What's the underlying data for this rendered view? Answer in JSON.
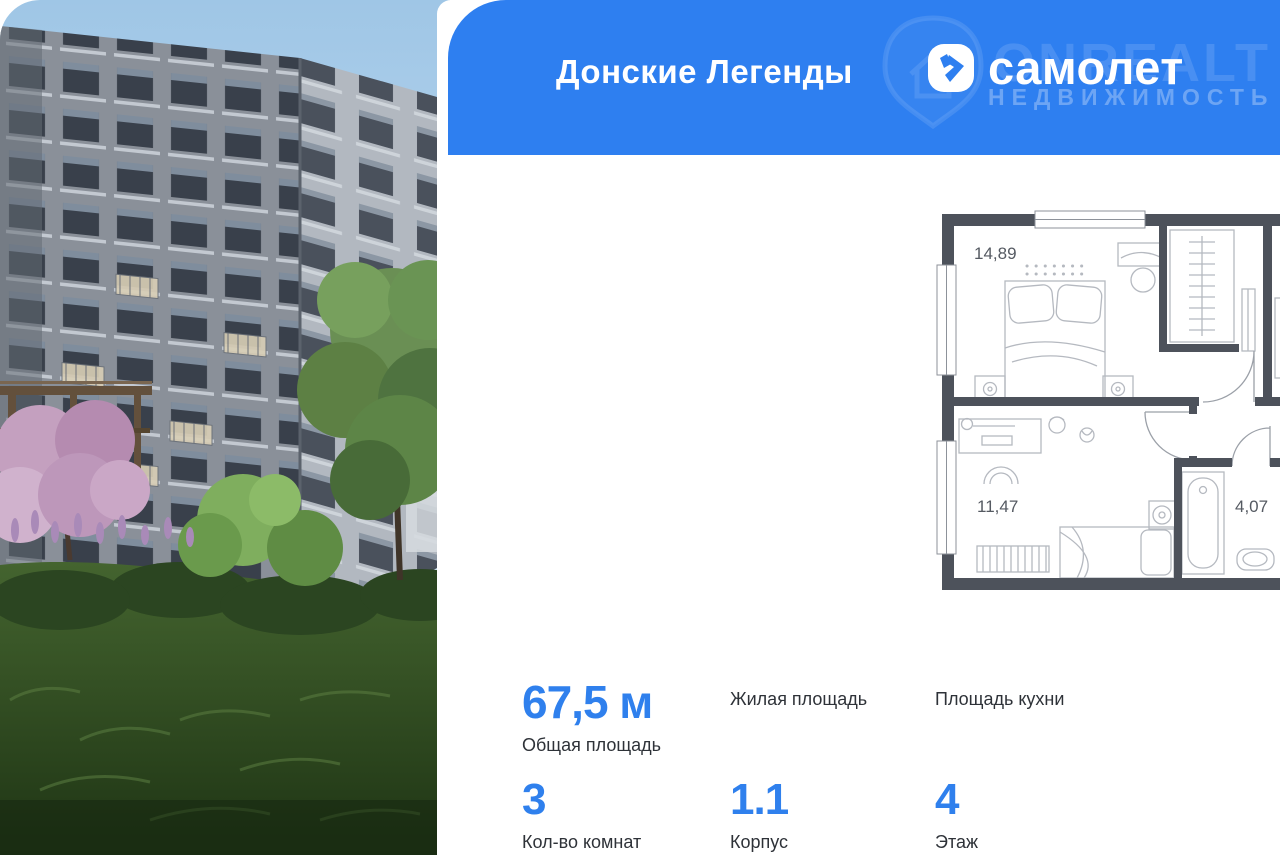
{
  "header": {
    "project_title": "Донские Легенды",
    "brand": "самолет",
    "watermark_line1": "ONREALT",
    "watermark_line2": "НЕДВИЖИМОСТЬ",
    "brand_color": "#2e7ff0"
  },
  "floor_plan": {
    "type": "apartment-floor-plan",
    "rooms": [
      {
        "id": "bedroom-1",
        "area": "14,89"
      },
      {
        "id": "bedroom-2",
        "area": "10,33"
      },
      {
        "id": "kitchen-dining",
        "area": "11,43"
      },
      {
        "id": "bedroom-3",
        "area": "11,47"
      },
      {
        "id": "bathroom",
        "area": "4,07"
      },
      {
        "id": "wc",
        "area": "1,89"
      },
      {
        "id": "hallway",
        "area": "5,97"
      },
      {
        "id": "entry-hall",
        "area": "3,62"
      },
      {
        "id": "corridor",
        "area": "3,79"
      }
    ],
    "wall_color": "#4d525b"
  },
  "stats": {
    "top": [
      {
        "value": "67,5 м",
        "label": "Общая площадь"
      },
      {
        "value": "",
        "label": "Жилая площадь"
      },
      {
        "value": "",
        "label": "Площадь кухни"
      }
    ],
    "bottom": [
      {
        "value": "3",
        "label": "Кол-во комнат"
      },
      {
        "value": "1.1",
        "label": "Корпус"
      },
      {
        "value": "4",
        "label": "Этаж"
      }
    ],
    "accent_color": "#2f80ed"
  }
}
